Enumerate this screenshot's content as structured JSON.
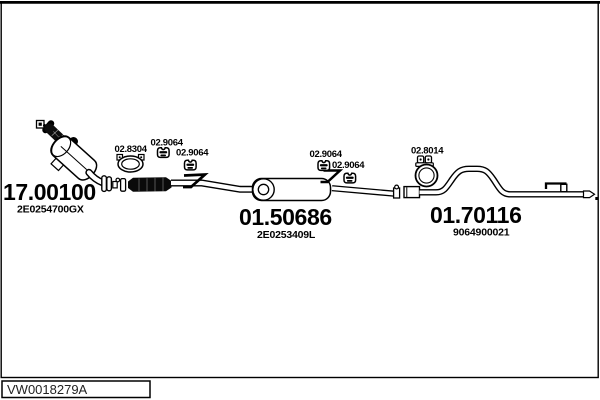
{
  "title": "Exhaust system parts diagram",
  "colors": {
    "ink": "#000000",
    "paper": "#ffffff"
  },
  "parts": {
    "catalyst": {
      "number": "17.00100",
      "oem": "2E0254700GX"
    },
    "middle_silencer": {
      "number": "01.50686",
      "oem": "2E0253409L"
    },
    "rear_pipe": {
      "number": "01.70116",
      "oem": "9064900021"
    },
    "clamp_front": {
      "number": "02.8304"
    },
    "hanger_front_1": {
      "number": "02.9064"
    },
    "hanger_front_2": {
      "number": "02.9064"
    },
    "hanger_mid_1": {
      "number": "02.9064"
    },
    "hanger_mid_2": {
      "number": "02.9064"
    },
    "clamp_rear": {
      "number": "02.8014"
    }
  },
  "footer": {
    "code": "VW0018279A"
  },
  "icons": {
    "rubber_hanger": "rubber-hanger-icon",
    "pipe_clamp": "pipe-clamp-icon",
    "hook_bracket": "hook-bracket-icon"
  }
}
